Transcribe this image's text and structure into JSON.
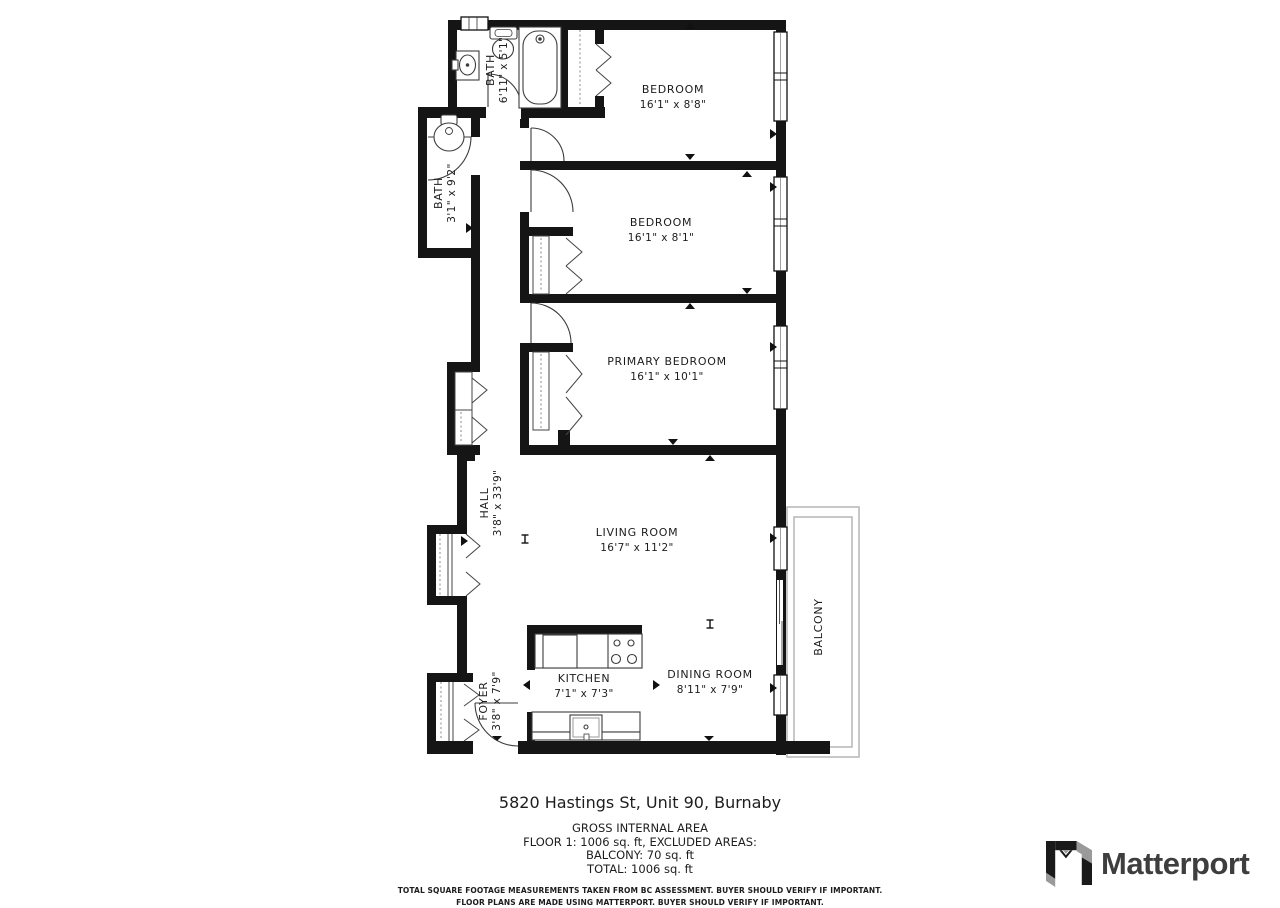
{
  "colors": {
    "wall": "#151515",
    "fixture_outline": "#3c3c3c",
    "closet_dash": "#888888",
    "balcony_outline": "#b5b5b5",
    "text": "#1c1c1c",
    "logo_black": "#1a1a1a",
    "logo_gray": "#9a9a9a",
    "logo_text_color": "#3e3e3e"
  },
  "floorplan": {
    "rooms": {
      "bath_upper": {
        "name": "BATH",
        "dims": "6'11\" x 5'1\""
      },
      "bath_hall": {
        "name": "BATH",
        "dims": "3'1\" x 9'2\""
      },
      "bedroom_1": {
        "name": "BEDROOM",
        "dims": "16'1\" x 8'8\""
      },
      "bedroom_2": {
        "name": "BEDROOM",
        "dims": "16'1\" x 8'1\""
      },
      "primary_bedroom": {
        "name": "PRIMARY BEDROOM",
        "dims": "16'1\" x 10'1\""
      },
      "hall": {
        "name": "HALL",
        "dims": "3'8\" x 33'9\""
      },
      "living_room": {
        "name": "LIVING ROOM",
        "dims": "16'7\" x 11'2\""
      },
      "kitchen": {
        "name": "KITCHEN",
        "dims": "7'1\" x 7'3\""
      },
      "dining_room": {
        "name": "DINING ROOM",
        "dims": "8'11\" x 7'9\""
      },
      "foyer": {
        "name": "FOYER",
        "dims": "3'8\" x 7'9\""
      },
      "balcony": {
        "name": "BALCONY"
      }
    }
  },
  "footer": {
    "address": "5820 Hastings St, Unit 90, Burnaby",
    "summary_heading": "GROSS INTERNAL AREA",
    "summary_line_1": "FLOOR 1: 1006 sq. ft, EXCLUDED AREAS:",
    "summary_line_2": "BALCONY: 70 sq. ft",
    "summary_line_3": "TOTAL: 1006 sq. ft",
    "disclaimer_line_1": "TOTAL SQUARE FOOTAGE MEASUREMENTS TAKEN FROM BC ASSESSMENT. BUYER SHOULD VERIFY IF IMPORTANT.",
    "disclaimer_line_2": "FLOOR PLANS ARE MADE USING MATTERPORT. BUYER SHOULD VERIFY IF IMPORTANT."
  },
  "branding": {
    "logo_text": "Matterport"
  }
}
